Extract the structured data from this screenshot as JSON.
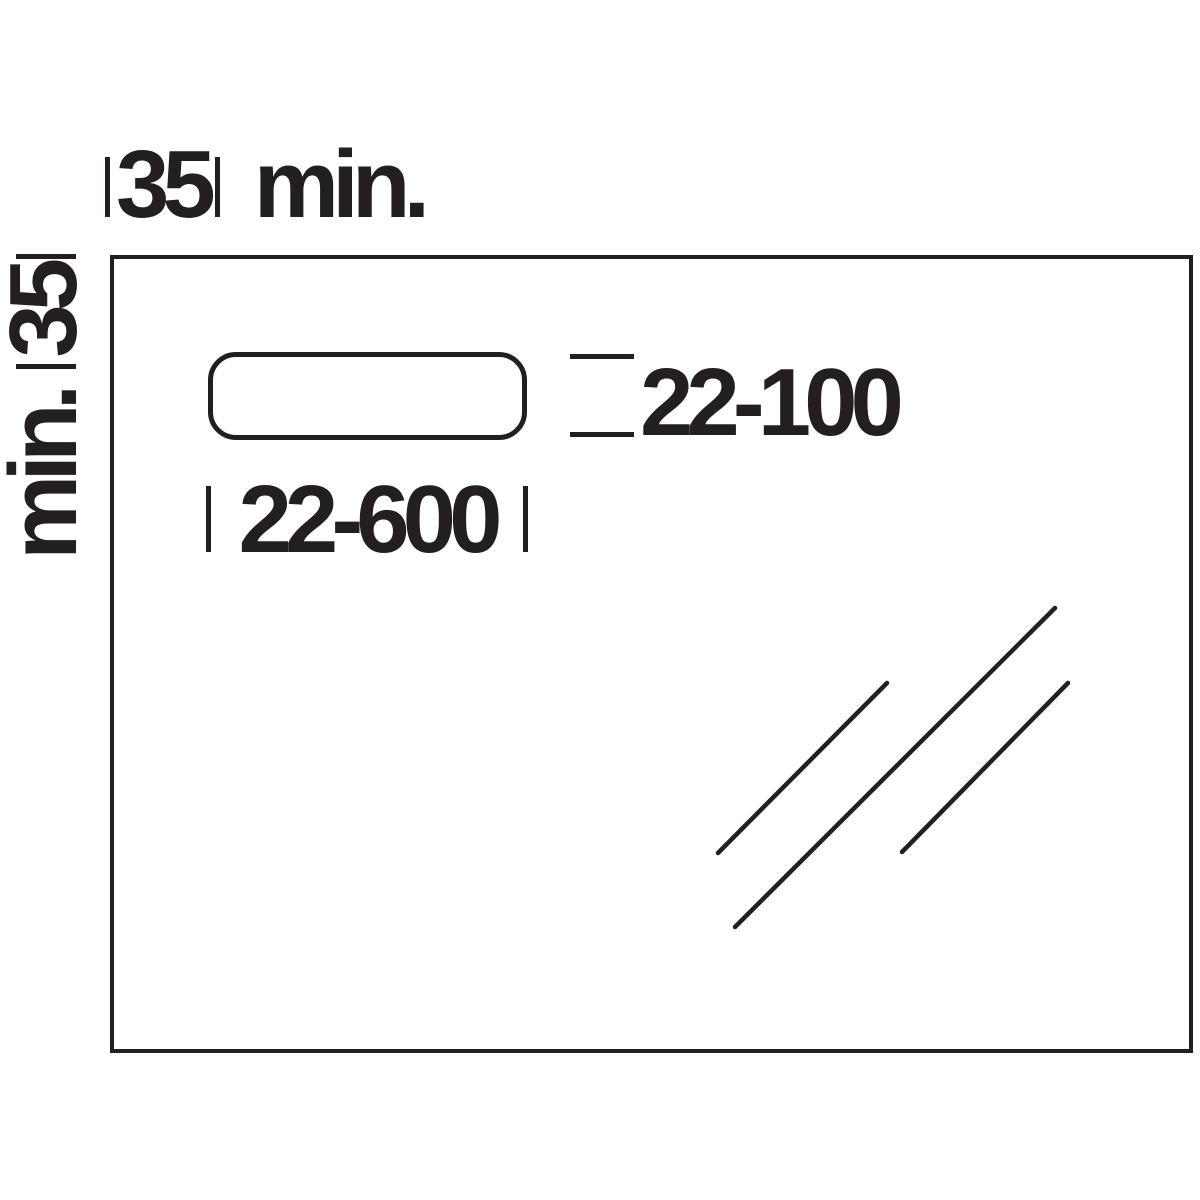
{
  "colors": {
    "ink": "#231f20",
    "paper": "#ffffff"
  },
  "labels": {
    "top_dimension_value": "35",
    "top_dimension_unit": "min.",
    "left_dimension_value": "35",
    "left_dimension_unit": "min.",
    "cutout_width": "22-600",
    "cutout_height": "22-100"
  }
}
